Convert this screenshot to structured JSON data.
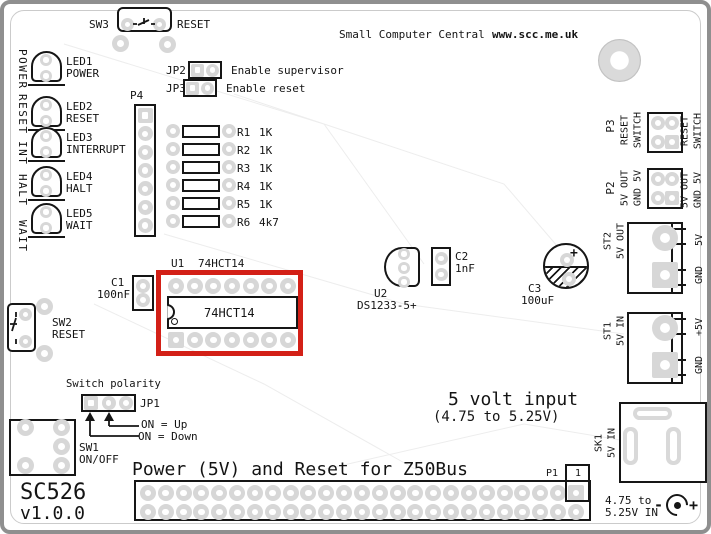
{
  "header": {
    "brand": "Small Computer Central",
    "website": "www.scc.me.uk"
  },
  "board": {
    "name": "SC526",
    "version": "v1.0.0",
    "title": "Power (5V) and Reset for Z50Bus",
    "highlight_color": "#d32017"
  },
  "edge_left_words": [
    {
      "w": "POWER"
    },
    {
      "w": "RESET"
    },
    {
      "w": "INT"
    },
    {
      "w": "HALT"
    },
    {
      "w": "WAIT"
    }
  ],
  "sw3": {
    "ref": "SW3",
    "label": "RESET"
  },
  "leds": [
    {
      "ref": "LED1",
      "func": "POWER"
    },
    {
      "ref": "LED2",
      "func": "RESET"
    },
    {
      "ref": "LED3",
      "func": "INTERRUPT"
    },
    {
      "ref": "LED4",
      "func": "HALT"
    },
    {
      "ref": "LED5",
      "func": "WAIT"
    }
  ],
  "p4": {
    "ref": "P4"
  },
  "jp2": {
    "ref": "JP2",
    "desc": "Enable supervisor"
  },
  "jp3": {
    "ref": "JP3",
    "desc": "Enable reset"
  },
  "resistors": [
    {
      "ref": "R1",
      "value": "1K"
    },
    {
      "ref": "R2",
      "value": "1K"
    },
    {
      "ref": "R3",
      "value": "1K"
    },
    {
      "ref": "R4",
      "value": "1K"
    },
    {
      "ref": "R5",
      "value": "1K"
    },
    {
      "ref": "R6",
      "value": "4k7"
    }
  ],
  "u1": {
    "ref": "U1",
    "part": "74HCT14"
  },
  "c1": {
    "ref": "C1",
    "value": "100nF"
  },
  "sw2": {
    "ref": "SW2",
    "label": "RESET"
  },
  "u2": {
    "ref": "U2",
    "part": "DS1233-5+"
  },
  "c2": {
    "ref": "C2",
    "value": "1nF"
  },
  "c3": {
    "ref": "C3",
    "value": "100uF",
    "plus": "+"
  },
  "p3": {
    "ref": "P3",
    "line1": "RESET",
    "line2": "SWITCH",
    "edge1": "RESET",
    "edge2": "SWITCH"
  },
  "p2": {
    "ref": "P2",
    "line1": "5V OUT",
    "line2": "GND 5V",
    "edge1": "5V OUT",
    "edge2": "GND 5V"
  },
  "st2": {
    "ref": "ST2",
    "label": "5V OUT",
    "edge_top": "5V",
    "edge_bot": "GND"
  },
  "st1": {
    "ref": "ST1",
    "label": "5V IN",
    "edge_top": "+5V",
    "edge_bot": "GND"
  },
  "sk1": {
    "ref": "SK1",
    "label": "5V IN"
  },
  "jp1": {
    "title": "Switch polarity",
    "ref": "JP1",
    "note_up": "ON = Up",
    "note_down": "ON = Down"
  },
  "sw1": {
    "ref": "SW1",
    "label": "ON/OFF"
  },
  "p1": {
    "ref": "P1",
    "pin1": "1"
  },
  "power_note": {
    "line1": "5 volt input",
    "line2": "(4.75 to 5.25V)"
  },
  "input_note": {
    "line1": "4.75 to",
    "line2": "5.25V IN",
    "minus": "-",
    "plus": "+"
  }
}
